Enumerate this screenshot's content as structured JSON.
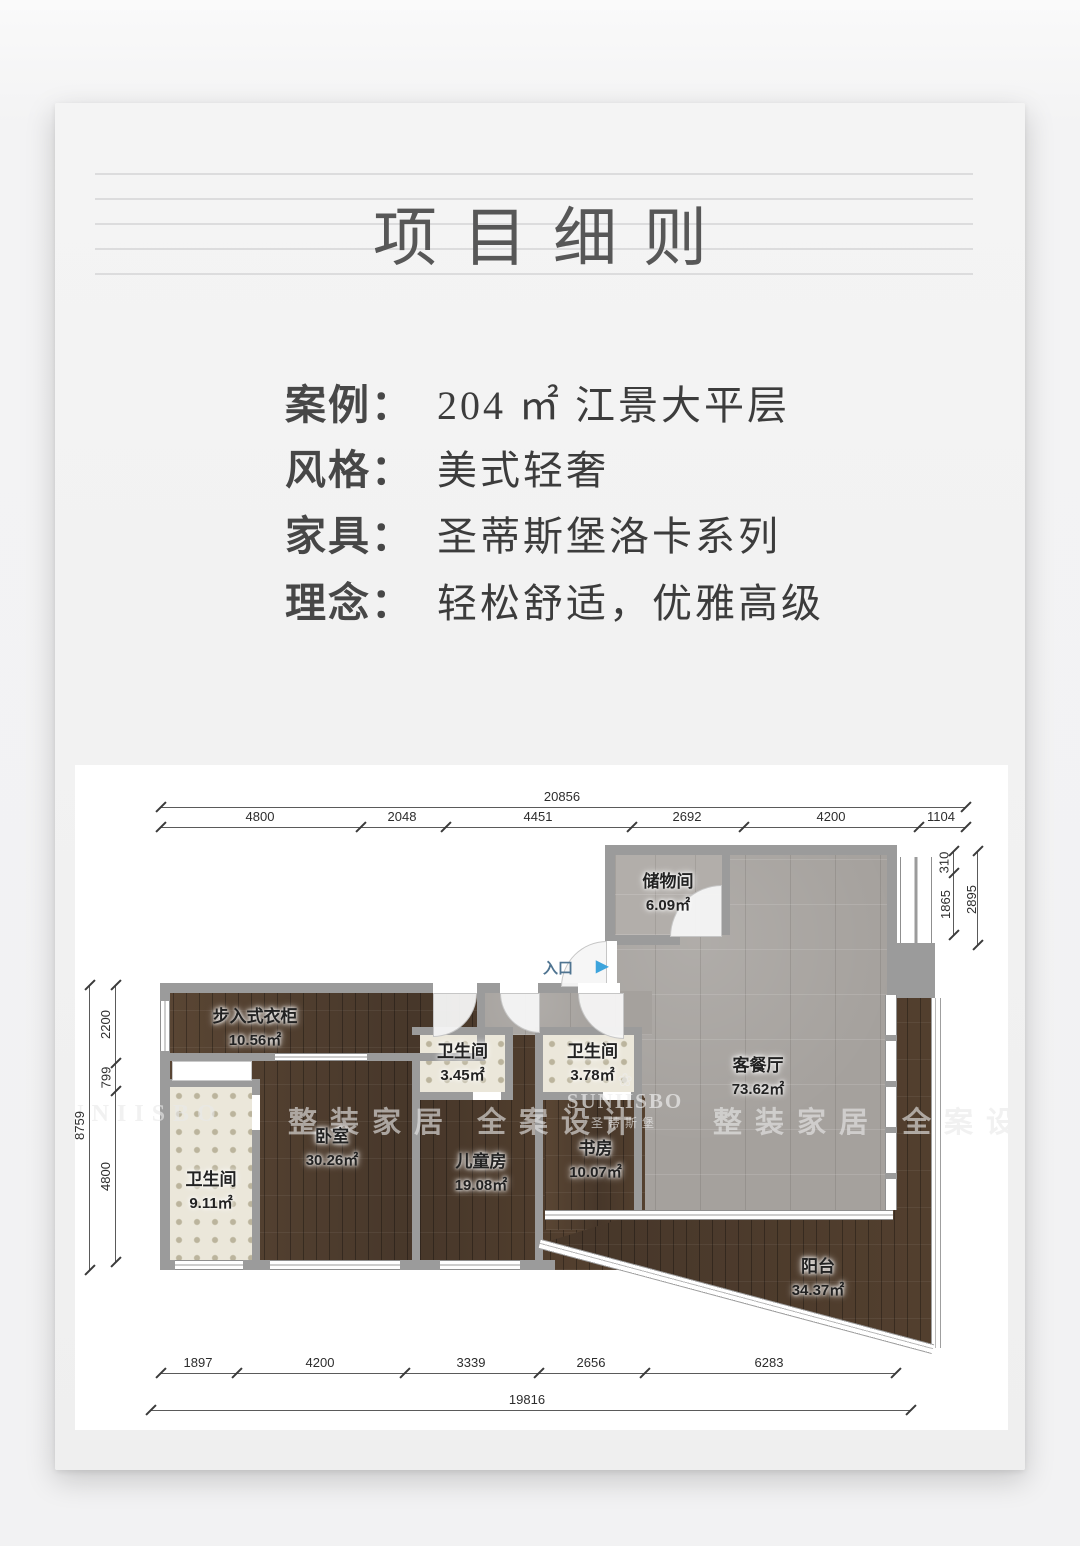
{
  "page": {
    "title": "项目细则"
  },
  "details": {
    "rows": [
      {
        "label": "案例：",
        "value": "204 ㎡ 江景大平层"
      },
      {
        "label": "风格：",
        "value": "美式轻奢"
      },
      {
        "label": "家具：",
        "value": "圣蒂斯堡洛卡系列"
      },
      {
        "label": "理念：",
        "value": "轻松舒适，优雅高级"
      }
    ]
  },
  "plan": {
    "entrance": {
      "label": "入口",
      "arrow": "▶"
    },
    "rooms": [
      {
        "name": "储物间",
        "area": "6.09㎡"
      },
      {
        "name": "客餐厅",
        "area": "73.62㎡"
      },
      {
        "name": "步入式衣柜",
        "area": "10.56㎡"
      },
      {
        "name": "卫生间",
        "area": "3.45㎡"
      },
      {
        "name": "卫生间",
        "area": "3.78㎡"
      },
      {
        "name": "卧室",
        "area": "30.26㎡"
      },
      {
        "name": "儿童房",
        "area": "19.08㎡"
      },
      {
        "name": "书房",
        "area": "10.07㎡"
      },
      {
        "name": "卫生间",
        "area": "9.11㎡"
      },
      {
        "name": "阳台",
        "area": "34.37㎡"
      }
    ],
    "dims": {
      "top": {
        "total": "20856",
        "segments": [
          "4800",
          "2048",
          "4451",
          "2692",
          "4200",
          "1104"
        ]
      },
      "bottom": {
        "total": "19816",
        "segments": [
          "1897",
          "4200",
          "3339",
          "2656",
          "6283"
        ]
      },
      "left": {
        "total": "8759",
        "segments": [
          "2200",
          "799",
          "4800"
        ]
      },
      "right": {
        "total": "2895",
        "segments": [
          "310",
          "1865"
        ]
      }
    },
    "watermarks": {
      "brand": "SUNIISBO",
      "brand_cn": "圣蒂斯堡",
      "slogan": "整装家居 全案设计",
      "flower": "❀"
    }
  }
}
